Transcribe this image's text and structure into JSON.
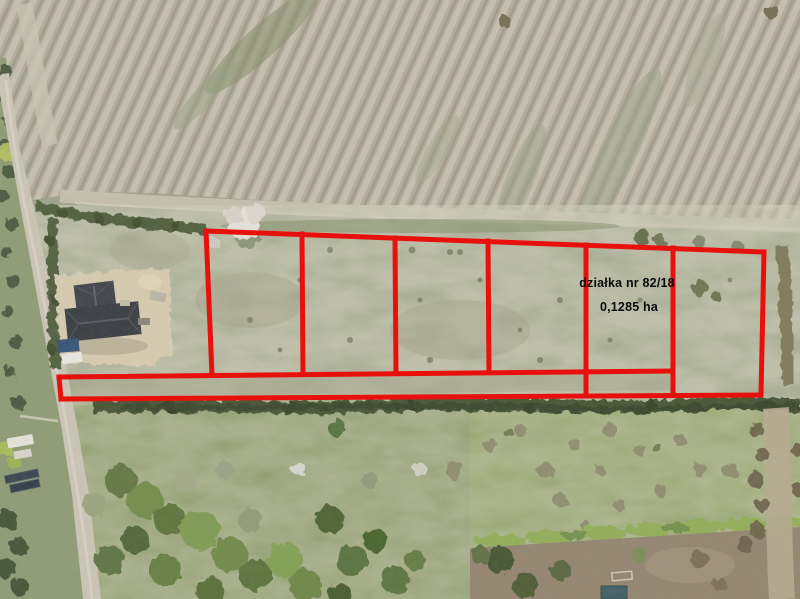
{
  "annotation": {
    "parcel_label": "działka nr 82/18",
    "area_label": "0,1285 ha",
    "boundary_color": "#e8100c",
    "label_color": "#000000",
    "parcel_count": 6
  },
  "scene": {
    "plowed_field_color": "#b3ac9c",
    "grassland_color": "#9da289",
    "meadow_color": "#85955e",
    "treeline_color": "#42502e",
    "road_color": "#cbc5b6",
    "house_roof_color": "#383b42"
  }
}
